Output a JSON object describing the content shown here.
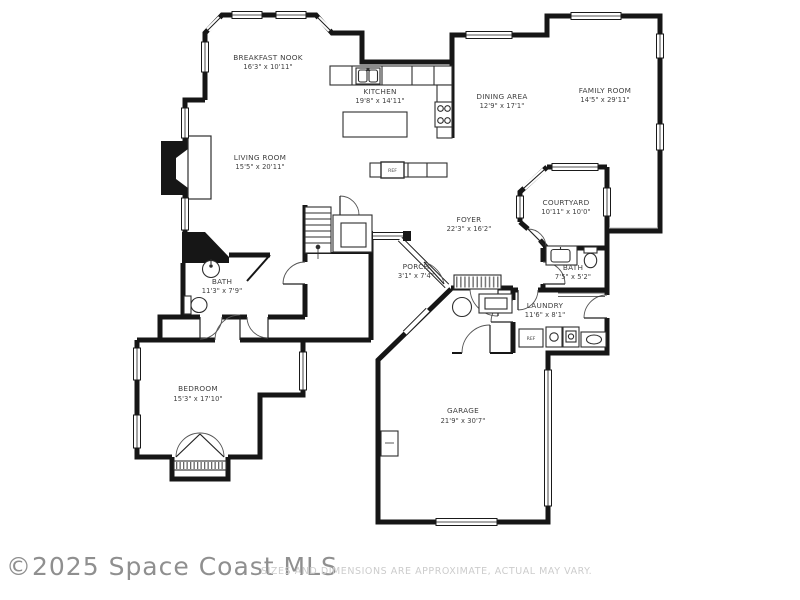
{
  "footer": {
    "watermark": "©2025 Space Coast MLS",
    "disclaimer": "SIZES AND DIMENSIONS ARE APPROXIMATE, ACTUAL MAY VARY."
  },
  "colors": {
    "wall": "#161616",
    "background": "#ffffff",
    "label_text": "#3f3f3f",
    "watermark_text": "#8f8f8f",
    "disclaimer_text": "#cccccc"
  },
  "rooms": [
    {
      "id": "breakfast-nook",
      "name": "BREAKFAST NOOK",
      "dims": "16'3\" x 10'11\""
    },
    {
      "id": "kitchen",
      "name": "KITCHEN",
      "dims": "19'8\" x 14'11\""
    },
    {
      "id": "dining-area",
      "name": "DINING AREA",
      "dims": "12'9\" x 17'1\""
    },
    {
      "id": "family-room",
      "name": "FAMILY ROOM",
      "dims": "14'5\" x 29'11\""
    },
    {
      "id": "living-room",
      "name": "LIVING ROOM",
      "dims": "15'5\" x 20'11\""
    },
    {
      "id": "foyer",
      "name": "FOYER",
      "dims": "22'3\" x 16'2\""
    },
    {
      "id": "courtyard",
      "name": "COURTYARD",
      "dims": "10'11\" x 10'0\""
    },
    {
      "id": "porch",
      "name": "PORCH",
      "dims": "3'1\" x 7'4\""
    },
    {
      "id": "bath-main",
      "name": "BATH",
      "dims": "11'3\" x 7'9\""
    },
    {
      "id": "bath-court",
      "name": "BATH",
      "dims": "7'5\" x 5'2\""
    },
    {
      "id": "laundry",
      "name": "LAUNDRY",
      "dims": "11'6\" x 8'1\""
    },
    {
      "id": "bedroom",
      "name": "BEDROOM",
      "dims": "15'3\" x 17'10\""
    },
    {
      "id": "garage",
      "name": "GARAGE",
      "dims": "21'9\" x 30'7\""
    }
  ],
  "fixtures": {
    "kitchen_ref_label": "REF",
    "laundry_ref_label": "REF"
  }
}
